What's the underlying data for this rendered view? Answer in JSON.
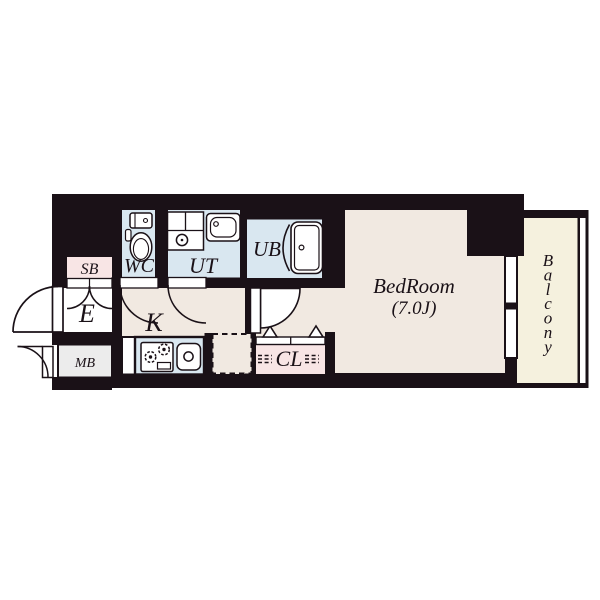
{
  "floor_plan": {
    "rooms": {
      "sb": {
        "label": "SB"
      },
      "wc": {
        "label": "WC"
      },
      "ut": {
        "label": "UT"
      },
      "ub": {
        "label": "UB"
      },
      "entrance": {
        "label": "E"
      },
      "kitchen": {
        "label": "K"
      },
      "mb": {
        "label": "MB"
      },
      "closet": {
        "label": "CL"
      },
      "bedroom": {
        "label": "BedRoom",
        "size": "(7.0J)"
      },
      "balcony": {
        "label": "Balcony"
      }
    },
    "colors": {
      "wall_black": "#1a1117",
      "floor_cream": "#f1e9e1",
      "wet_area_blue": "#d9e7f0",
      "storage_pink": "#f8e5e5",
      "meter_box_gray": "#ececec",
      "balcony_ivory": "#f5f1de",
      "white": "#ffffff"
    }
  }
}
